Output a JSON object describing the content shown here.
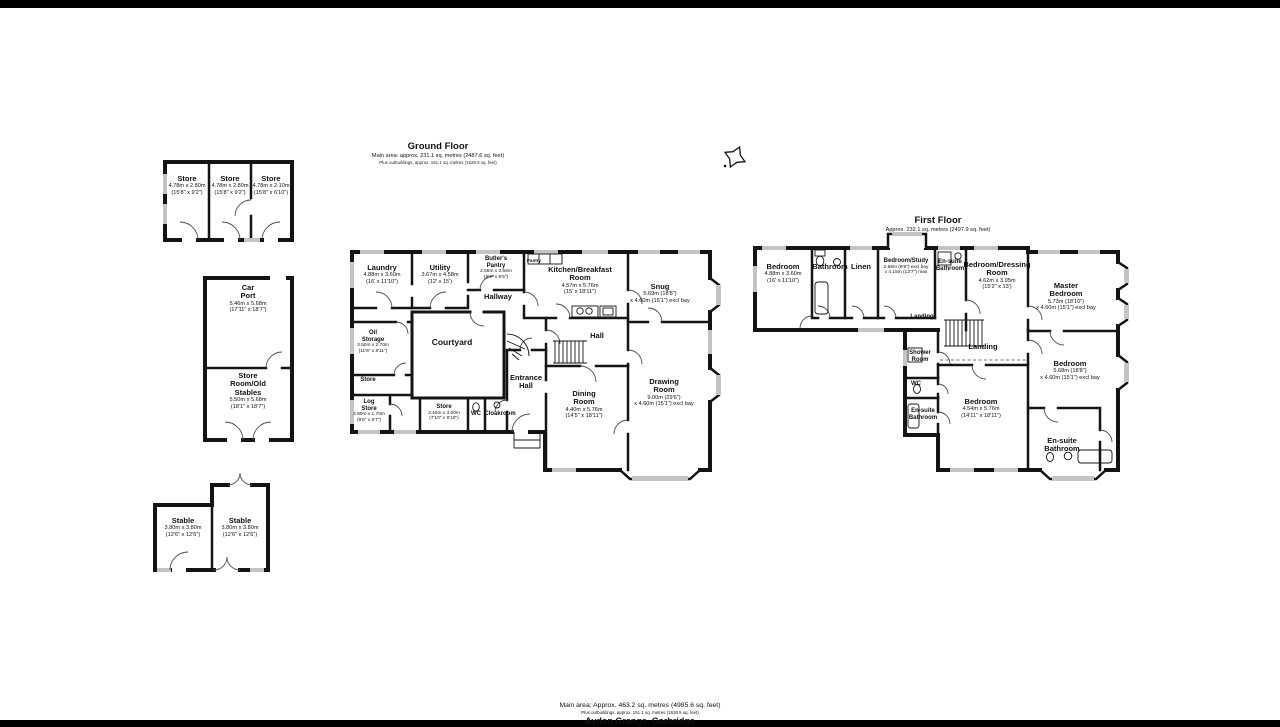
{
  "property": {
    "footer_line1": "Main area: Approx. 463.2 sq. metres (4985.6 sq. feet)",
    "footer_line2": "Plus outbuildings, approx. 151.1 sq. metres (1626.5 sq. feet)",
    "footer_title": "Aydon Grange, Corbridge"
  },
  "colors": {
    "wall": "#141414",
    "window": "#c4c4c4",
    "background": "#ffffff",
    "frame": "#000000"
  },
  "compass": {
    "icon": "north-pointer"
  },
  "ground_floor": {
    "title": "Ground Floor",
    "subtitle": "Main area: approx. 231.1 sq. metres (2487.6 sq. feet)",
    "subtitle2": "Plus outbuildings, approx. 151.1 sq. metres (1626.5 sq. feet)",
    "rooms": [
      {
        "name": "Laundry",
        "m": "4.88m x 3.60m",
        "ft": "(16' x 11'10\")",
        "x": 382,
        "y": 264
      },
      {
        "name": "Utility",
        "m": "3.67m x 4.58m",
        "ft": "(12' x 15')",
        "x": 440,
        "y": 264
      },
      {
        "name": "Butler's\nPantry",
        "m": "2.55m x 2.56m",
        "ft": "(8'4\" x 8'5\")",
        "x": 496,
        "y": 256,
        "size": "sm"
      },
      {
        "name": "Pantry",
        "x": 534,
        "y": 258,
        "size": "xs"
      },
      {
        "name": "Kitchen/Breakfast\nRoom",
        "m": "4.57m x 5.76m",
        "ft": "(15' x 18'11\")",
        "x": 580,
        "y": 266
      },
      {
        "name": "Snug",
        "m": "5.69m (18'8\")",
        "ft": "x 4.60m (15'1\") excl bay",
        "x": 660,
        "y": 283
      },
      {
        "name": "Hallway",
        "x": 498,
        "y": 293
      },
      {
        "name": "Courtyard",
        "x": 452,
        "y": 338,
        "size": "lg"
      },
      {
        "name": "Oil\nStorage",
        "m": "3.50m x 2.70m",
        "ft": "(11'6\" x 8'11\")",
        "x": 373,
        "y": 330,
        "size": "sm"
      },
      {
        "name": "Store",
        "x": 368,
        "y": 377,
        "size": "sm"
      },
      {
        "name": "Log\nStore",
        "m": "2.90m x 1.70m",
        "ft": "(9'6\" x 5'7\")",
        "x": 369,
        "y": 399,
        "size": "sm"
      },
      {
        "name": "Store",
        "m": "2.40m x 3.00m",
        "ft": "(7'10\" x 9'10\")",
        "x": 444,
        "y": 404,
        "size": "sm"
      },
      {
        "name": "WC",
        "x": 476,
        "y": 411,
        "size": "sm"
      },
      {
        "name": "Cloakroom",
        "x": 500,
        "y": 411,
        "size": "sm"
      },
      {
        "name": "Entrance\nHall",
        "x": 526,
        "y": 374
      },
      {
        "name": "Hall",
        "x": 597,
        "y": 332
      },
      {
        "name": "Dining\nRoom",
        "m": "4.40m x 5.76m",
        "ft": "(14'5\" x 18'11\")",
        "x": 584,
        "y": 390
      },
      {
        "name": "Drawing\nRoom",
        "m": "9.00m (29'6\")",
        "ft": "x 4.60m (15'1\") excl bay",
        "x": 664,
        "y": 378
      }
    ]
  },
  "first_floor": {
    "title": "First Floor",
    "subtitle": "Approx. 232.1 sq. metres (2497.9 sq. feet)",
    "rooms": [
      {
        "name": "Bedroom",
        "m": "4.88m x 3.60m",
        "ft": "(16' x 11'10\")",
        "x": 783,
        "y": 263
      },
      {
        "name": "Bathroom",
        "x": 830,
        "y": 263
      },
      {
        "name": "Linen",
        "x": 861,
        "y": 263
      },
      {
        "name": "Bedroom/Study",
        "m": "2.66m (8'9\") excl bay",
        "ft": "x 4.15m (13'7\") max",
        "x": 906,
        "y": 258,
        "size": "sm"
      },
      {
        "name": "En-suite\nBathroom",
        "x": 950,
        "y": 259,
        "size": "sm"
      },
      {
        "name": "Bedroom/Dressing\nRoom",
        "m": "4.62m x 3.95m",
        "ft": "(15'2\" x 13')",
        "x": 997,
        "y": 261
      },
      {
        "name": "Master\nBedroom",
        "m": "5.73m (18'10\")",
        "ft": "x 4.60m (15'1\") excl bay",
        "x": 1066,
        "y": 282
      },
      {
        "name": "Landing",
        "x": 922,
        "y": 314,
        "size": "sm"
      },
      {
        "name": "Landing",
        "x": 983,
        "y": 343
      },
      {
        "name": "Shower\nRoom",
        "x": 920,
        "y": 350,
        "size": "sm"
      },
      {
        "name": "WC",
        "x": 916,
        "y": 381,
        "size": "sm"
      },
      {
        "name": "En-suite\nBathroom",
        "x": 923,
        "y": 408,
        "size": "sm"
      },
      {
        "name": "Bedroom",
        "m": "4.54m x 5.76m",
        "ft": "(14'11\" x 18'11\")",
        "x": 981,
        "y": 398
      },
      {
        "name": "Bedroom",
        "m": "5.68m (18'8\")",
        "ft": "x 4.60m (15'1\") excl bay",
        "x": 1070,
        "y": 360
      },
      {
        "name": "En-suite\nBathroom",
        "x": 1062,
        "y": 437
      }
    ]
  },
  "outbuildings": {
    "rooms": [
      {
        "name": "Store",
        "m": "4.78m x 2.80m",
        "ft": "(15'8\" x 9'2\")",
        "x": 187,
        "y": 175
      },
      {
        "name": "Store",
        "m": "4.78m x 2.80m",
        "ft": "(15'8\" x 9'2\")",
        "x": 230,
        "y": 175
      },
      {
        "name": "Store",
        "m": "4.78m x 2.10m",
        "ft": "(15'8\" x 6'10\")",
        "x": 271,
        "y": 175
      },
      {
        "name": "Car\nPort",
        "m": "5.46m x 5.68m",
        "ft": "(17'11\" x 18'7\")",
        "x": 248,
        "y": 284
      },
      {
        "name": "Store\nRoom/Old\nStables",
        "m": "5.50m x 5.68m",
        "ft": "(18'1\" x 18'7\")",
        "x": 248,
        "y": 372
      },
      {
        "name": "Stable",
        "m": "3.80m x 3.80m",
        "ft": "(12'6\" x 12'6\")",
        "x": 183,
        "y": 517
      },
      {
        "name": "Stable",
        "m": "3.80m x 3.80m",
        "ft": "(12'6\" x 12'6\")",
        "x": 240,
        "y": 517
      }
    ]
  }
}
